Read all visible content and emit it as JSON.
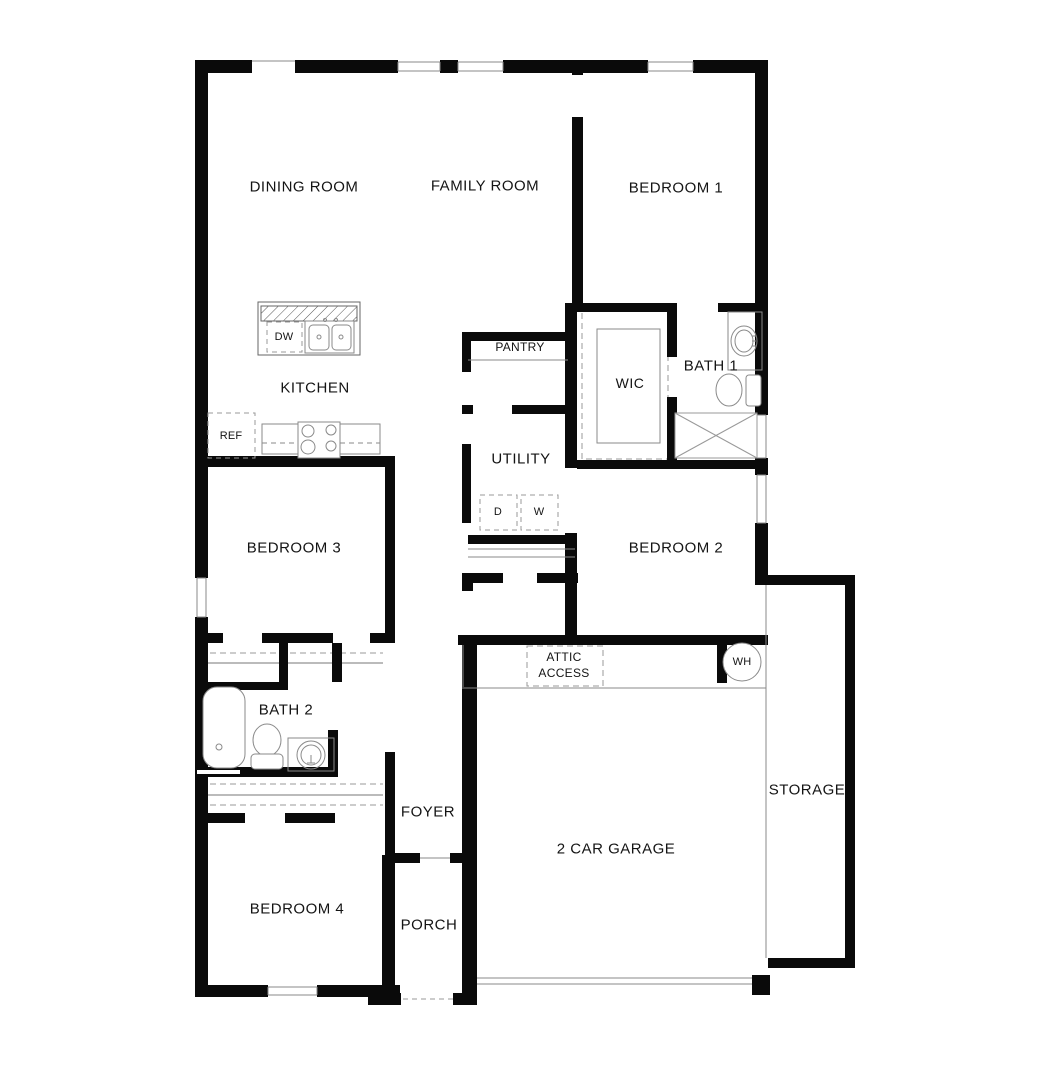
{
  "page": {
    "background": "#ffffff",
    "wall_color": "#0a0a0a",
    "fixture_line_color": "#8a8a8a",
    "dash_color": "#9a9a9a"
  },
  "labels": {
    "dining_room": "DINING ROOM",
    "family_room": "FAMILY ROOM",
    "bedroom_1": "BEDROOM 1",
    "kitchen": "KITCHEN",
    "pantry": "PANTRY",
    "wic": "WIC",
    "bath_1": "BATH 1",
    "ref": "REF",
    "dw": "DW",
    "dryer": "D",
    "washer": "W",
    "utility": "UTILITY",
    "bedroom_3": "BEDROOM 3",
    "bedroom_2": "BEDROOM 2",
    "attic_line1": "ATTIC",
    "attic_line2": "ACCESS",
    "wh": "WH",
    "bath_2": "BATH 2",
    "foyer": "FOYER",
    "storage": "STORAGE",
    "garage": "2 CAR GARAGE",
    "bedroom_4": "BEDROOM 4",
    "porch": "PORCH"
  }
}
